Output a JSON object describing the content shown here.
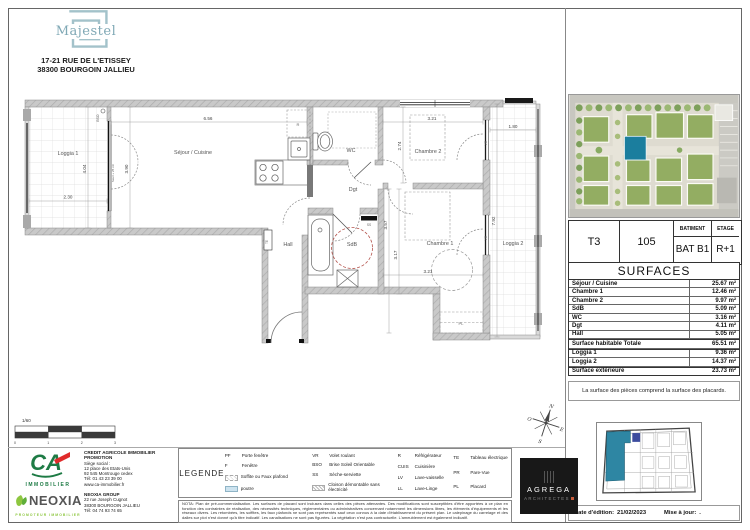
{
  "header": {
    "brand": "Majestel",
    "address1": "17-21 RUE DE L'ETISSEY",
    "address2": "38300 BOURGOIN JALLIEU"
  },
  "unit": {
    "type": "T3",
    "number": "105",
    "batiment_label": "BATIMENT",
    "etage_label": "ETAGE",
    "batiment": "BAT B1",
    "etage": "R+1"
  },
  "surfaces": {
    "title": "SURFACES",
    "rows": [
      {
        "label": "Séjour / Cuisine",
        "value": "25.67 m²"
      },
      {
        "label": "Chambre 1",
        "value": "12.46 m²"
      },
      {
        "label": "Chambre 2",
        "value": "9.97 m²"
      },
      {
        "label": "SdB",
        "value": "5.09 m²"
      },
      {
        "label": "WC",
        "value": "3.16 m²"
      },
      {
        "label": "Dgt",
        "value": "4.11 m²"
      },
      {
        "label": "Hall",
        "value": "5.05 m²"
      },
      {
        "label": "Surface habitable Totale",
        "value": "65.51 m²"
      },
      {
        "label": "Loggia 1",
        "value": "9.36 m²"
      },
      {
        "label": "Loggia 2",
        "value": "14.37 m²"
      },
      {
        "label": "Surface extérieure",
        "value": "23.73 m²"
      }
    ],
    "note": "La surface des pièces comprend la surface des placards."
  },
  "edition": {
    "date_label": "Date d'édition:",
    "date": "21/02/2023",
    "maj_label": "Mise à jour:",
    "maj": "."
  },
  "plan": {
    "scale_label": "1/60",
    "scale_ticks": [
      "0",
      "1",
      "2",
      "3"
    ],
    "compass": {
      "n": "N",
      "o": "O",
      "e": "E",
      "s": "S"
    },
    "rooms": {
      "loggia1": "Loggia 1",
      "sejour": "Séjour / Cuisine",
      "wc": "WC",
      "chambre2": "Chambre 2",
      "dgt": "Dgt",
      "sdb": "SdB",
      "hall": "Hall",
      "chambre1": "Chambre 1",
      "loggia2": "Loggia 2"
    },
    "annotations": {
      "bso": "BSO",
      "vr": "VR",
      "seuil": "Seuil + 25 cm",
      "te": "TE",
      "ss": "SS",
      "pl": "PL",
      "r": "R"
    },
    "dims": {
      "sejour_w": "6.56",
      "sejour_h": "3.90",
      "loggia1_w": "2.30",
      "loggia1_h": "4.04",
      "chambre2_w": "3.21",
      "chambre2_h": "2.74",
      "chambre1_w": "3.21",
      "chambre1_h": "3.57",
      "sdb_h": "3.17",
      "loggia2_w": "1.80",
      "loggia2_h": "7.92"
    }
  },
  "legend": {
    "title": "LEGENDE",
    "items": [
      {
        "abbr": "PF",
        "label": "Porte fenêtre"
      },
      {
        "abbr": "F",
        "label": "Fenêtre"
      },
      {
        "abbr": "",
        "label": "Soffite ou Faux plafond"
      },
      {
        "abbr": "",
        "label": "poutre"
      },
      {
        "abbr": "VR",
        "label": "Volet roulant"
      },
      {
        "abbr": "BSO",
        "label": "Brise Soleil Orientable"
      },
      {
        "abbr": "SS",
        "label": "Sèche-serviette"
      },
      {
        "abbr": "",
        "label": "Cloison démontable sans électricité"
      },
      {
        "abbr": "R",
        "label": "Réfrigérateur"
      },
      {
        "abbr": "CUIS",
        "label": "Cuisinière"
      },
      {
        "abbr": "LV",
        "label": "Lave-vaisselle"
      },
      {
        "abbr": "LL",
        "label": "Lave-Linge"
      },
      {
        "abbr": "TE",
        "label": "Tableau électrique"
      },
      {
        "abbr": "PR",
        "label": "Pare-Vue"
      },
      {
        "abbr": "PL",
        "label": "Placard"
      }
    ]
  },
  "nota": "NOTA: Plan de pré-commercialisation. Les surfaces de placard sont incluses dans celles des pièces attenantes. Des modifications sont susceptibles d'être apportées à ce plan en fonction des contraintes de réalisation, des nécessités techniques, réglementaires ou administratives concernant notamment les dimensions libres, les éléments d'équipements et les réseaux divers. Les retombées, les soffites, les faux plafonds ne sont pas représentés sauf ceux connus à la date d'établissement du présent plan. Le calepinage du carrelage et des dalles sur plot n'est donné qu'à titre indicatif. Les canalisations ne sont pas figurées. La végétation n'est pas contractuelle. L'ameublement est également indicatif.",
  "developers": {
    "ca": {
      "logo": "CA",
      "logo_sub": "IMMOBILIER",
      "name": "CREDIT AGRICOLE IMMOBILIER PROMOTION",
      "lines": [
        "Siège social :",
        "12 place des Etats-Unis",
        "92 545 Montrouge cedex",
        "Tél: 01 43 23 39 00",
        "www.ca-immobilier.fr"
      ]
    },
    "neoxia": {
      "logo": "NEOXIA",
      "logo_sub": "PROMOTEUR IMMOBILIER",
      "name": "NEOXIA GROUP",
      "lines": [
        "22 rue Joseph Cugnot",
        "38300 BOURGOIN JALLIEU",
        "Tél: 04 74 93 74 65"
      ]
    }
  },
  "architect": {
    "name": "AGREGA",
    "sub": "ARCHITECTES"
  },
  "colors": {
    "brand_teal": "#7FA8B5",
    "logo_outline": "#A3C2CA",
    "unit_highlight": "#2E86A3",
    "site_highlight": "#1B7E9E",
    "accessibility_circle": "#B5534C",
    "legend_poutre": "#CDE3EF",
    "ca_green": "#1E7B45",
    "ca_red": "#E02B2B",
    "neoxia_green": "#8DC63F",
    "agrega_accent": "#C75B39",
    "wall_gray": "#C9C9C9"
  }
}
